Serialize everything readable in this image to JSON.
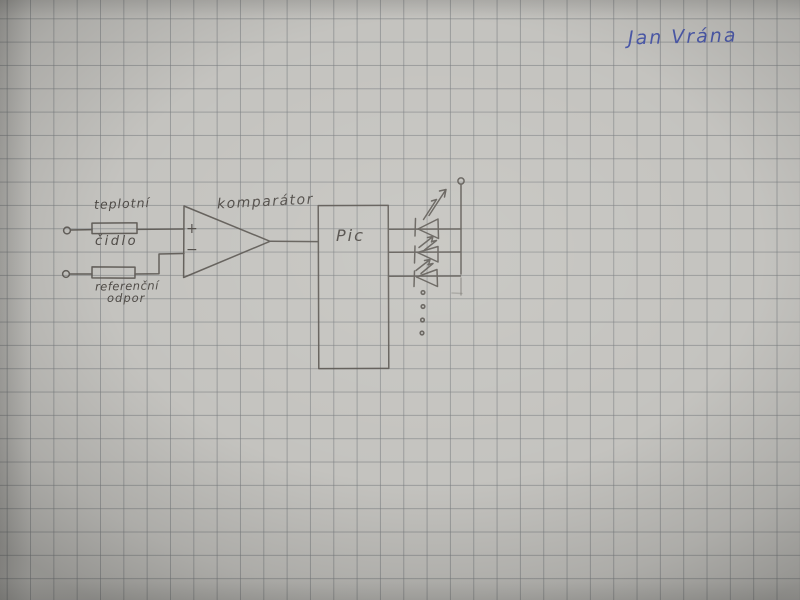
{
  "page": {
    "kind": "photograph of a hand-drawn electronic schematic on squared (graph) paper",
    "signature": "Jan Vrána"
  },
  "diagram": {
    "labels": {
      "sensor_line1": "teplotní",
      "sensor_line2": "čidlo",
      "reference_line1": "referenční",
      "reference_line2": "odpor",
      "comparator": "komparátor",
      "mcu": "Pic",
      "plus_input": "+",
      "minus_input": "−"
    },
    "components": [
      {
        "id": "input-terminal-1",
        "type": "open-terminal"
      },
      {
        "id": "input-terminal-2",
        "type": "open-terminal"
      },
      {
        "id": "sensor-resistor",
        "type": "resistor-box",
        "label": "teplotní čidlo"
      },
      {
        "id": "reference-resistor",
        "type": "resistor-box",
        "label": "referenční odpor"
      },
      {
        "id": "comparator",
        "type": "op-amp-triangle",
        "label": "komparátor",
        "inputs": [
          "+",
          "−"
        ]
      },
      {
        "id": "mcu-box",
        "type": "ic-rectangle",
        "label": "Pic"
      },
      {
        "id": "led-array",
        "type": "led",
        "count": 3,
        "more_dots": 4
      },
      {
        "id": "supply-terminal",
        "type": "open-terminal"
      }
    ]
  },
  "colors": {
    "paper": "#c4c3bf",
    "grid_line": "#9b9d9e",
    "pencil": "#55514c",
    "pen_blue": "#4a58aa"
  }
}
